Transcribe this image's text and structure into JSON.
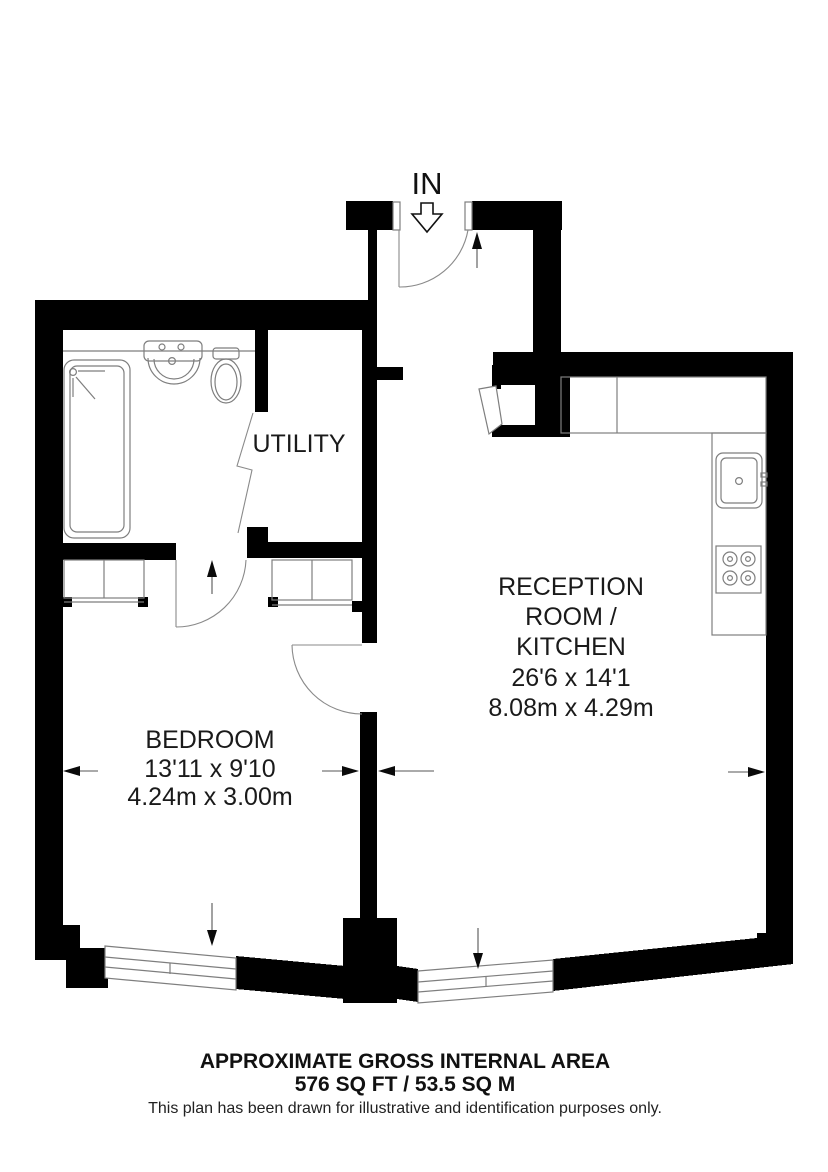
{
  "plan": {
    "entrance_label": "IN",
    "rooms": {
      "utility": {
        "name": "UTILITY"
      },
      "bedroom": {
        "name": "BEDROOM",
        "dims_imperial": "13'11 x 9'10",
        "dims_metric": "4.24m x 3.00m"
      },
      "reception": {
        "name_line1": "RECEPTION",
        "name_line2": "ROOM /",
        "name_line3": "KITCHEN",
        "dims_imperial": "26'6 x 14'1",
        "dims_metric": "8.08m x 4.29m"
      }
    }
  },
  "footer": {
    "title": "APPROXIMATE GROSS INTERNAL AREA",
    "area": "576 SQ FT / 53.5 SQ M",
    "disclaimer": "This plan has been drawn for illustrative and identification purposes only."
  },
  "colors": {
    "wall": "#000000",
    "fixture_line": "#7e7e7e",
    "background": "#ffffff",
    "text": "#1a1a1a"
  }
}
